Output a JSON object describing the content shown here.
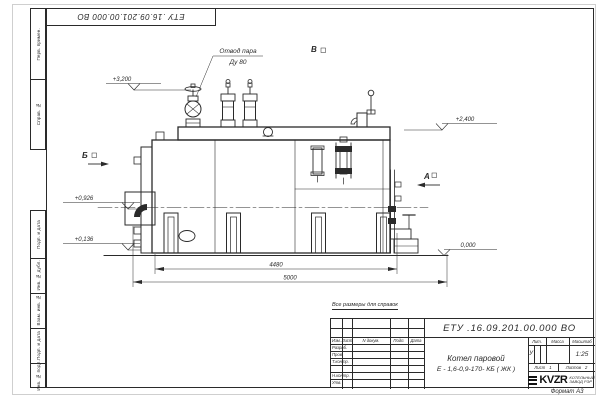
{
  "sheet": {
    "designation": "ЕТУ .16.09.201.00.000  ВО",
    "corner_designation": "ЕТУ .16.09.201.00.000  ВО",
    "note": "Все размеры для справок",
    "format_label": "Формат А3"
  },
  "margin_stamps": {
    "perv_primen": "Перв. примен.",
    "sprav_no": "Справ. №",
    "podp_data_top": "Подп. и дата",
    "inv_dubl": "Инв. № дубл.",
    "vzam_inv": "Взам. инв. №",
    "podp_data_bottom": "Подп. и дата",
    "inv_podl": "Инв. № подл."
  },
  "title_block": {
    "col_izm": "Изм.",
    "col_list": "Лист",
    "col_docum": "N докум.",
    "col_podp": "Подп.",
    "col_data": "Дата",
    "row_razrab": "Разраб.",
    "row_prov": "Пров.",
    "row_tkontr": "Т.контр.",
    "row_nkontr": "Н.контр.",
    "row_utv": "Утв.",
    "product_line1": "Котел паровой",
    "product_line2": "Е - 1,6-0,9-170- КБ ( ЖК )",
    "lit_label": "Лит.",
    "lit_value": "У",
    "mass_label": "Масса",
    "scale_label": "Масштаб",
    "scale_value": "1:25",
    "sheet_label": "Лист",
    "sheet_value": "1",
    "sheets_label": "Листов",
    "sheets_value": "2",
    "company_logo": "KVZR",
    "company_line1": "КОТЕЛЬНЫЙ",
    "company_line2": "ЗАВОД РЭР"
  },
  "annotations": {
    "steam_outlet_line1": "Отвод пара",
    "steam_outlet_line2": "Ду 80",
    "view_v": "В",
    "view_b": "Б",
    "view_a": "А",
    "elev_plus3200": "+3,200",
    "elev_plus2400": "+2,400",
    "elev_plus0926": "+0,926",
    "elev_plus0136": "+0,136",
    "elev_zero": "0,000",
    "dim_4480": "4480",
    "dim_5000": "5000"
  }
}
